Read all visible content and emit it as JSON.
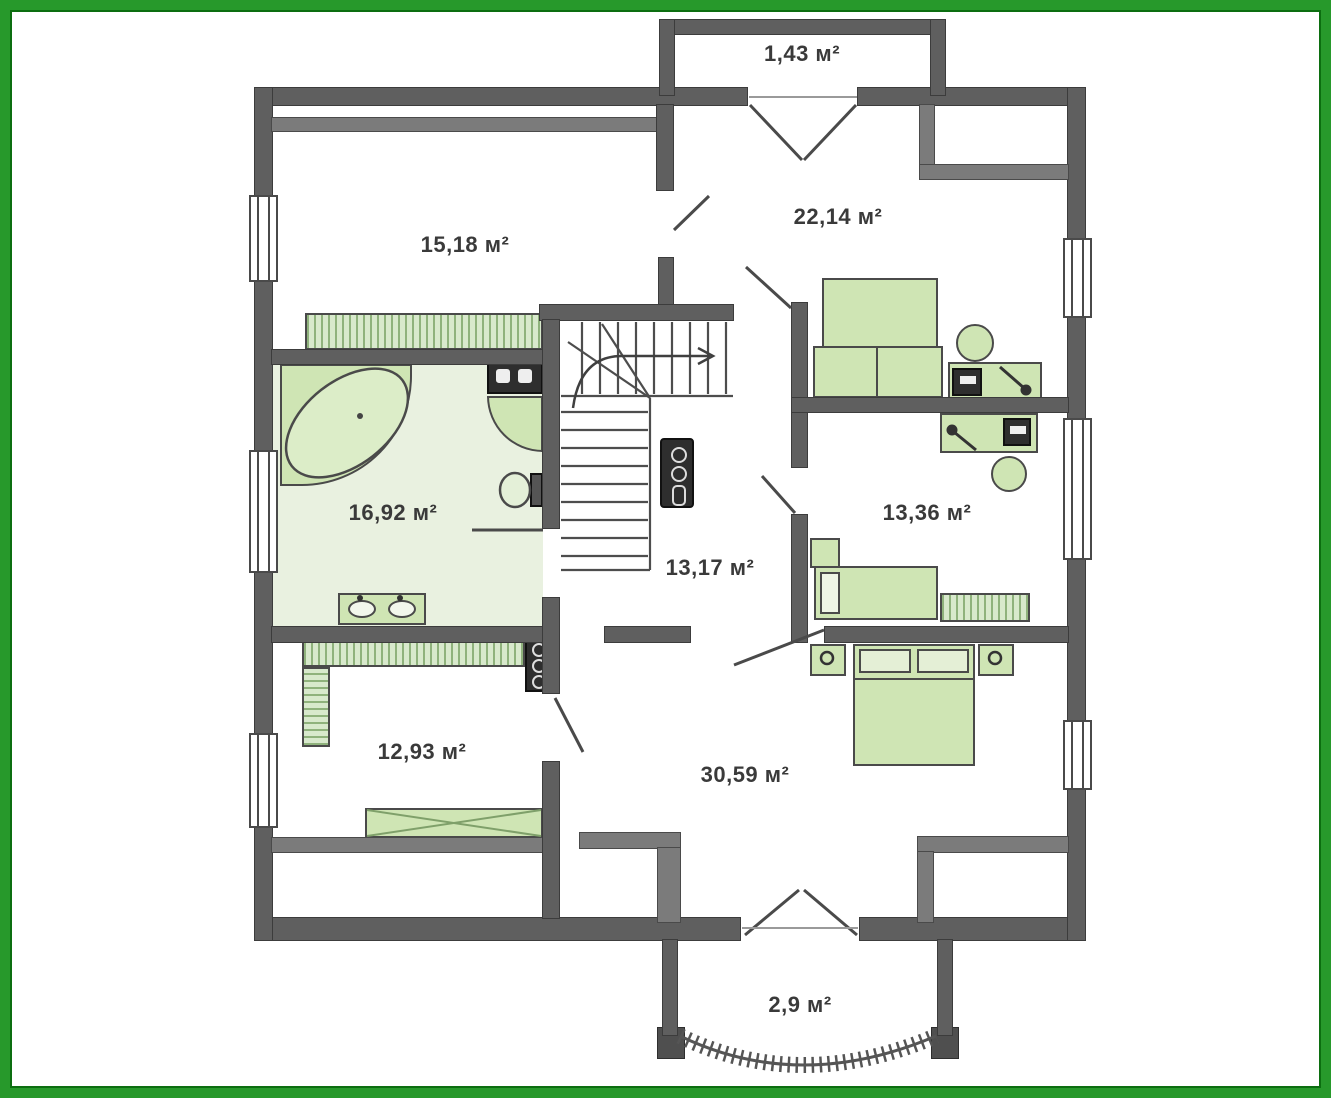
{
  "plan_title": "attic floor plan",
  "units": "м²",
  "colors": {
    "frame_green": "#27992b",
    "frame_inner_green": "#0c6e10",
    "wall_gray": "#5f5f5f",
    "knee_wall_gray": "#7b7b7b",
    "furniture_green": "#cfe5b4",
    "bath_floor_green": "#e9f1e0",
    "line_dark": "#4a4a4a"
  },
  "rooms": [
    {
      "id": "balcony-top",
      "area": "1,43 м²"
    },
    {
      "id": "room-top-left",
      "area": "15,18 м²"
    },
    {
      "id": "room-top-right",
      "area": "22,14 м²"
    },
    {
      "id": "bathroom",
      "area": "16,92 м²"
    },
    {
      "id": "room-right",
      "area": "13,36 м²"
    },
    {
      "id": "hallway",
      "area": "13,17 м²"
    },
    {
      "id": "room-bottom-left",
      "area": "12,93 м²"
    },
    {
      "id": "room-master",
      "area": "30,59 м²"
    },
    {
      "id": "balcony-bottom",
      "area": "2,9 м²"
    }
  ]
}
